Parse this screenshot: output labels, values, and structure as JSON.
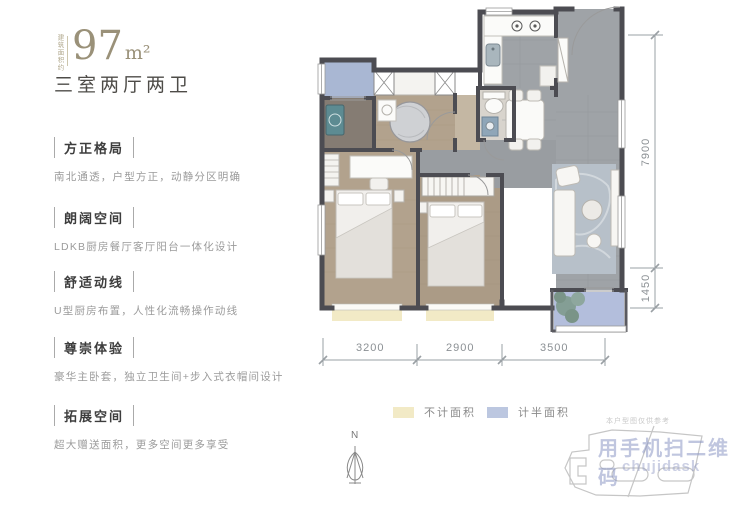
{
  "header": {
    "area_prefix": "建筑面积约",
    "area_value": "97",
    "area_unit": "m²",
    "layout": "三室两厅两卫"
  },
  "features": [
    {
      "title": "方正格局",
      "desc": "南北通透，户型方正，动静分区明确"
    },
    {
      "title": "朗阔空间",
      "desc": "LDKB厨房餐厅客厅阳台一体化设计"
    },
    {
      "title": "舒适动线",
      "desc": "U型厨房布置，人性化流畅操作动线"
    },
    {
      "title": "尊崇体验",
      "desc": "豪华主卧套，独立卫生间+步入式衣帽间设计"
    },
    {
      "title": "拓展空间",
      "desc": "超大赠送面积，更多空间更多享受"
    }
  ],
  "dims": {
    "right": [
      "7900",
      "1450"
    ],
    "bottom": [
      "3200",
      "2900",
      "3500"
    ]
  },
  "legend": {
    "items": [
      {
        "label": "不计面积",
        "color": "#f2eac6"
      },
      {
        "label": "计半面积",
        "color": "#bcc7e0"
      }
    ]
  },
  "north": {
    "label": "N"
  },
  "watermark": {
    "caption": "本户型图仅供参考",
    "line1": "用手机扫二维码",
    "line2": "chujidask"
  },
  "colors": {
    "accent_gold": "#9a9179",
    "wall": "#4c4c52",
    "floor_wood": "#b2a28d",
    "floor_tile": "#9fa3a7",
    "balcony_half_area": "#aab8d2",
    "bay_no_area": "#f2eac6",
    "watermark": "#8d97c4"
  }
}
